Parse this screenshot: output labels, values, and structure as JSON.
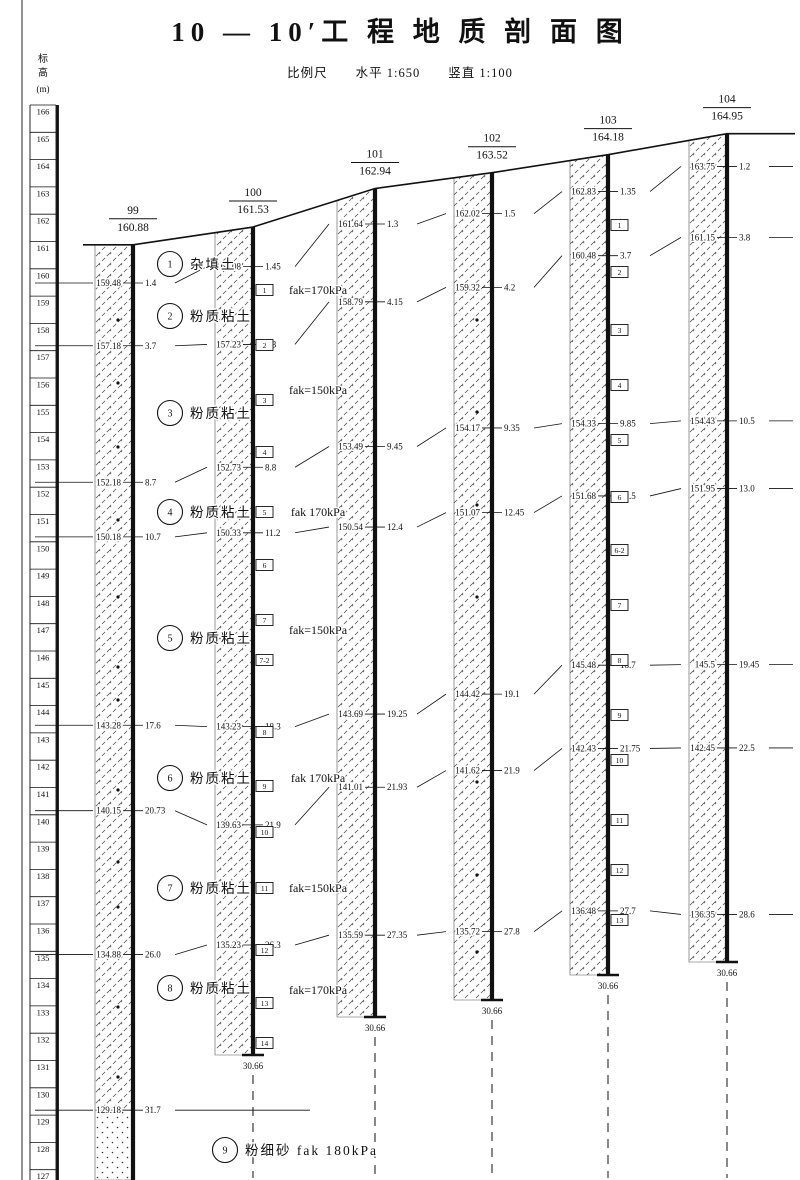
{
  "title": "10 — 10′工 程 地 质 剖 面 图",
  "scale": {
    "prefix": "比例尺",
    "horizontal": "水平 1:650",
    "vertical": "竖直 1:100"
  },
  "axis": {
    "header_top": "标",
    "header_bottom": "高",
    "header_unit": "(m)",
    "top": 166,
    "bottom": 127
  },
  "ink_color": "#111111",
  "boreholes": [
    {
      "id": "99",
      "elevation": "160.88",
      "x": 133,
      "term_y": null,
      "term_label": null,
      "sand_top_elev": 129.18,
      "dots_x": 118,
      "dots_y": [
        320,
        383,
        447,
        520,
        597,
        667,
        700,
        790,
        862,
        907,
        1007,
        1077
      ],
      "boxes": []
    },
    {
      "id": "100",
      "elevation": "161.53",
      "x": 253,
      "term_y": 1055,
      "term_label": "30.66",
      "boxes": [
        [
          "1",
          290
        ],
        [
          "2",
          345
        ],
        [
          "3",
          400
        ],
        [
          "4",
          452
        ],
        [
          "5",
          512
        ],
        [
          "6",
          565
        ],
        [
          "7",
          620
        ],
        [
          "7-2",
          660
        ],
        [
          "8",
          732
        ],
        [
          "9",
          786
        ],
        [
          "10",
          832
        ],
        [
          "11",
          888
        ],
        [
          "12",
          950
        ],
        [
          "13",
          1003
        ],
        [
          "14",
          1043
        ]
      ]
    },
    {
      "id": "101",
      "elevation": "162.94",
      "x": 375,
      "term_y": 1017,
      "term_label": "30.66",
      "boxes": []
    },
    {
      "id": "102",
      "elevation": "163.52",
      "x": 492,
      "term_y": 1000,
      "term_label": "30.66",
      "dots_x": 477,
      "dots_y": [
        320,
        412,
        505,
        597,
        690,
        782,
        875,
        952
      ],
      "boxes": []
    },
    {
      "id": "103",
      "elevation": "164.18",
      "x": 608,
      "term_y": 975,
      "term_label": "30.66",
      "boxes": [
        [
          "1",
          225
        ],
        [
          "2",
          272
        ],
        [
          "3",
          330
        ],
        [
          "4",
          385
        ],
        [
          "5",
          440
        ],
        [
          "6",
          497
        ],
        [
          "6-2",
          550
        ],
        [
          "7",
          605
        ],
        [
          "8",
          660
        ],
        [
          "9",
          715
        ],
        [
          "10",
          760
        ],
        [
          "11",
          820
        ],
        [
          "12",
          870
        ],
        [
          "13",
          920
        ]
      ]
    },
    {
      "id": "104",
      "elevation": "164.95",
      "x": 727,
      "term_y": 962,
      "term_label": "30.66",
      "boxes": []
    }
  ],
  "boundaries": [
    {
      "elevs": [
        "159.48",
        "160.08",
        "161.64",
        "162.02",
        "162.83",
        "163.75"
      ],
      "depths": [
        "1.4",
        "1.45",
        "1.3",
        "1.5",
        "1.35",
        "1.2"
      ]
    },
    {
      "elevs": [
        "157.18",
        "157.23",
        "158.79",
        "159.32",
        "160.48",
        "161.15"
      ],
      "depths": [
        "3.7",
        "4.3",
        "4.15",
        "4.2",
        "3.7",
        "3.8"
      ]
    },
    {
      "elevs": [
        "152.18",
        "152.73",
        "153.49",
        "154.17",
        "154.33",
        "154.43"
      ],
      "depths": [
        "8.7",
        "8.8",
        "9.45",
        "9.35",
        "9.85",
        "10.5"
      ]
    },
    {
      "elevs": [
        "150.18",
        "150.33",
        "150.54",
        "151.07",
        "151.68",
        "151.95"
      ],
      "depths": [
        "10.7",
        "11.2",
        "12.4",
        "12.45",
        "12.5",
        "13.0"
      ]
    },
    {
      "elevs": [
        "143.28",
        "143.23",
        "143.69",
        "144.42",
        "145.48",
        "145.5"
      ],
      "depths": [
        "17.6",
        "18.3",
        "19.25",
        "19.1",
        "18.7",
        "19.45"
      ]
    },
    {
      "elevs": [
        "140.15",
        "139.63",
        "141.01",
        "141.62",
        "142.43",
        "142.45"
      ],
      "depths": [
        "20.73",
        "21.9",
        "21.93",
        "21.9",
        "21.75",
        "22.5"
      ]
    },
    {
      "elevs": [
        "134.88",
        "135.23",
        "135.59",
        "135.72",
        "136.48",
        "136.35"
      ],
      "depths": [
        "26.0",
        "26.3",
        "27.35",
        "27.8",
        "27.7",
        "28.6"
      ]
    },
    {
      "elevs": [
        "129.18"
      ],
      "depths": [
        "31.7"
      ],
      "only_first": true,
      "right_end": 310
    }
  ],
  "layers": [
    {
      "num": "1",
      "name": "杂填土",
      "y": 264
    },
    {
      "num": "2",
      "name": "粉质粘土",
      "y": 316
    },
    {
      "num": "3",
      "name": "粉质粘土",
      "y": 413
    },
    {
      "num": "4",
      "name": "粉质粘土",
      "y": 512
    },
    {
      "num": "5",
      "name": "粉质粘土",
      "y": 638
    },
    {
      "num": "6",
      "name": "粉质粘土",
      "y": 778
    },
    {
      "num": "7",
      "name": "粉质粘土",
      "y": 888
    },
    {
      "num": "8",
      "name": "粉质粘土",
      "y": 988
    },
    {
      "num": "9",
      "name": "粉细砂 fak 180kPa",
      "y": 1150,
      "cx": 225
    }
  ],
  "fak_labels": [
    {
      "text": "fak=170kPa",
      "y": 290
    },
    {
      "text": "fak=150kPa",
      "y": 390
    },
    {
      "text": "fak 170kPa",
      "y": 512
    },
    {
      "text": "fak=150kPa",
      "y": 630
    },
    {
      "text": "fak 170kPa",
      "y": 778
    },
    {
      "text": "fak=150kPa",
      "y": 888
    },
    {
      "text": "fak=170kPa",
      "y": 990
    }
  ]
}
